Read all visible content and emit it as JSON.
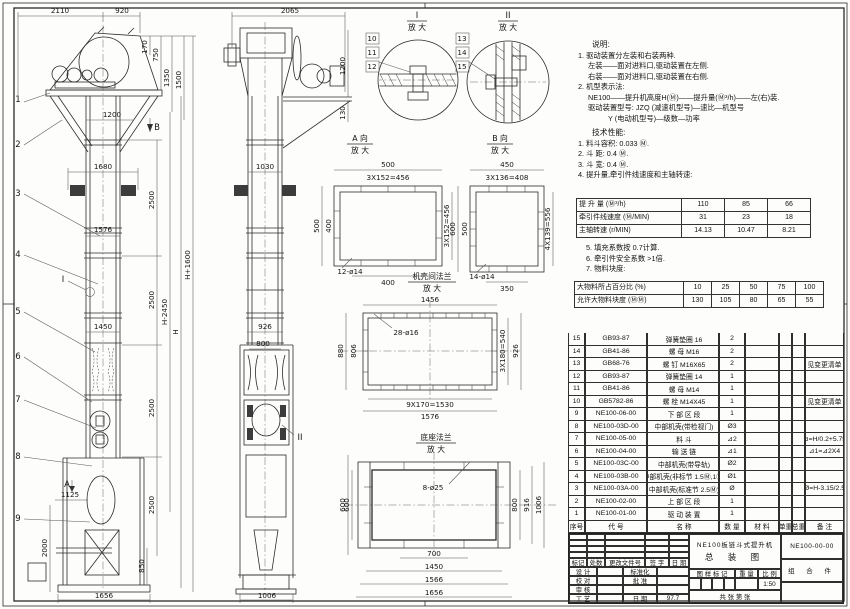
{
  "sheet": {
    "kind": "engineering-drawing"
  },
  "v1": {
    "callouts": [
      "1",
      "2",
      "3",
      "4",
      "5",
      "6",
      "7",
      "8",
      "9"
    ],
    "detail_mark": "I",
    "dim_2110": "2110",
    "dim_920": "920",
    "dim_170": "170",
    "dim_750": "750",
    "dim_1350": "1350",
    "dim_1500": "1500",
    "dim_1200": "1200",
    "view_b": "B",
    "dim_1680": "1680",
    "dim_2500": "2500",
    "dim_1576": "1576",
    "dim_1450": "1450",
    "dim_h2450": "H-2450",
    "dim_h": "H",
    "dim_h1600": "H+1600",
    "dim_1125": "1125",
    "dim_2000": "2000",
    "dim_850": "850",
    "dim_1656": "1656",
    "view_a": "A"
  },
  "v2": {
    "dim_2065": "2065",
    "dim_1200": "1200",
    "dim_130": "130",
    "dim_1030": "1030",
    "dim_926": "926",
    "dim_800": "800",
    "dim_600": "600",
    "dim_1006": "1006",
    "detail_mark": "II"
  },
  "detail1": {
    "label": "I",
    "sub": "放 大",
    "c10": "10",
    "c11": "11",
    "c12": "12"
  },
  "detail2": {
    "label": "II",
    "sub": "放 大",
    "c13": "13",
    "c14": "14",
    "c15": "15"
  },
  "viewA": {
    "title": "A 向",
    "sub": "放 大",
    "top": "500",
    "top2": "3X152=456",
    "left": "500",
    "left2": "400",
    "right": "3X152=456",
    "bottom": "400",
    "holes": "12-ø14"
  },
  "viewB": {
    "title": "B 向",
    "sub": "放 大",
    "top": "450",
    "top2": "3X136=408",
    "left": "600",
    "left2": "500",
    "right": "4X139=556",
    "bottom": "350",
    "holes": "14-ø14"
  },
  "flange1": {
    "title": "机壳间法兰",
    "sub": "放 大",
    "top": "1456",
    "holes": "28-ø16",
    "left": "880",
    "left2": "806",
    "right": "3X180=540",
    "right2": "926",
    "bottom": "9X170=1530",
    "bottom2": "1576"
  },
  "flange2": {
    "title": "底座法兰",
    "sub": "放 大",
    "holes": "8-ø25",
    "left": "600",
    "right": "800",
    "right2": "916",
    "right3": "1006",
    "bottom": "700",
    "bottom2": "1450",
    "bottom3": "1566",
    "bottom4": "1656"
  },
  "notes": {
    "title": "说明:",
    "n1": "1. 驱动装置分左装和右装两种.",
    "n2": "左装——面对进料口,驱动装置在左侧.",
    "n3": "右装——面对进料口,驱动装置在右侧.",
    "n4": "2. 机型表示法:",
    "n5": "NE100——提升机高度H(Ⓜ)——提升量(Ⓜ³/h)——左(右)装.",
    "n6": "驱动装置型号: JZQ (减速机型号)—速比—机型号",
    "n7": "Y (电动机型号)—级数—功率",
    "tech_title": "技术性能:",
    "t1": "1. 料斗容积: 0.033 Ⓜ.",
    "t2": "2. 斗    距: 0.4 Ⓜ.",
    "t3": "3. 斗    宽: 0.4 Ⓜ.",
    "t4": "4. 提升量,牵引件线速度和主轴转速:",
    "t5": "5. 填充系数按 0.7计算.",
    "t6": "6. 牵引件安全系数 >1倍.",
    "t7": "7. 物料块度:"
  },
  "chart_data": {
    "type": "table",
    "title": "提升量、牵引件线速度和主轴转速",
    "perf_rows": [
      {
        "label": "提 升 量 (Ⓜ³/h)",
        "v1": "110",
        "v2": "85",
        "v3": "66"
      },
      {
        "label": "牵引件线速度 (Ⓜ/MIN)",
        "v1": "31",
        "v2": "23",
        "v3": "18"
      },
      {
        "label": "主轴转速 (r/MIN)",
        "v1": "14.13",
        "v2": "10.47",
        "v3": "8.21"
      }
    ],
    "size_rows": [
      {
        "label": "大物料所占百分比 (%)",
        "v1": "10",
        "v2": "25",
        "v3": "50",
        "v4": "75",
        "v5": "100"
      },
      {
        "label": "允许大物料块度 (ⓂⓂ)",
        "v1": "130",
        "v2": "105",
        "v3": "80",
        "v4": "65",
        "v5": "55"
      }
    ]
  },
  "bom": {
    "headers": {
      "seq": "序号",
      "code": "代    号",
      "name": "名    称",
      "qty": "数 量",
      "mat": "材  料",
      "uw": "单重",
      "tw": "总重",
      "note": "备  注"
    },
    "rows": [
      {
        "seq": "15",
        "code": "GB93-87",
        "name": "弹簧垫圈  16",
        "qty": "2",
        "mat": "",
        "uw": "",
        "tw": "",
        "note": ""
      },
      {
        "seq": "14",
        "code": "GB41-86",
        "name": "螺  母  M16",
        "qty": "2",
        "mat": "",
        "uw": "",
        "tw": "",
        "note": ""
      },
      {
        "seq": "13",
        "code": "GB68-76",
        "name": "螺  钉  M16X65",
        "qty": "2",
        "mat": "",
        "uw": "",
        "tw": "",
        "note": "见变更清单"
      },
      {
        "seq": "12",
        "code": "GB93-87",
        "name": "弹簧垫圈  14",
        "qty": "1",
        "mat": "",
        "uw": "",
        "tw": "",
        "note": ""
      },
      {
        "seq": "11",
        "code": "GB41-86",
        "name": "螺  母  M14",
        "qty": "1",
        "mat": "",
        "uw": "",
        "tw": "",
        "note": ""
      },
      {
        "seq": "10",
        "code": "GB5782-86",
        "name": "螺  栓  M14X45",
        "qty": "1",
        "mat": "",
        "uw": "",
        "tw": "",
        "note": "见变更清单"
      },
      {
        "seq": "9",
        "code": "NE100-06-00",
        "name": "下 部 区 段",
        "qty": "1",
        "mat": "",
        "uw": "",
        "tw": "",
        "note": ""
      },
      {
        "seq": "8",
        "code": "NE100-03D-00",
        "name": "中部机壳(带检视门)",
        "qty": "Ø3",
        "mat": "",
        "uw": "",
        "tw": "",
        "note": ""
      },
      {
        "seq": "7",
        "code": "NE100-05-00",
        "name": "料  斗",
        "qty": "⊿2",
        "mat": "",
        "uw": "",
        "tw": "",
        "note": "⊿=H/0.2+5.75"
      },
      {
        "seq": "6",
        "code": "NE100-04-00",
        "name": "输 送 链",
        "qty": "⊿1",
        "mat": "",
        "uw": "",
        "tw": "",
        "note": "⊿1=⊿2X4"
      },
      {
        "seq": "5",
        "code": "NE100-03C-00",
        "name": "中部机壳(带导轨)",
        "qty": "Ø2",
        "mat": "",
        "uw": "",
        "tw": "",
        "note": ""
      },
      {
        "seq": "4",
        "code": "NE100-03B-00",
        "name": "中部机壳(非标节 1.5Ⓜ,1Ⓜ)",
        "qty": "Ø1",
        "mat": "",
        "uw": "",
        "tw": "",
        "note": ""
      },
      {
        "seq": "3",
        "code": "NE100-03A-00",
        "name": "中部机壳(标准节 2.5Ⓜ)",
        "qty": "Ø",
        "mat": "",
        "uw": "",
        "tw": "",
        "note": "Ø=H-3.15/2.5"
      },
      {
        "seq": "2",
        "code": "NE100-02-00",
        "name": "上 部 区 段",
        "qty": "1",
        "mat": "",
        "uw": "",
        "tw": "",
        "note": ""
      },
      {
        "seq": "1",
        "code": "NE100-01-00",
        "name": "驱 动 装 置",
        "qty": "1",
        "mat": "",
        "uw": "",
        "tw": "",
        "note": ""
      }
    ]
  },
  "title_block": {
    "product_line1": "NE100板链斗式提升机",
    "product_line2": "总 装 图",
    "drawing_no": "NE100-00-00",
    "part_type": "组 合 件",
    "rev_headers": {
      "h1": "标记",
      "h2": "处数",
      "h3": "更改文件号",
      "h4": "签 字",
      "h5": "日 期"
    },
    "roles": {
      "r1": "设 计",
      "r2": "校 对",
      "r3": "审 核",
      "r4": "工 艺",
      "s1": "标准化",
      "s2": "批 准",
      "s4": "日 期",
      "date": "97.7"
    },
    "stamp": {
      "h1": "图 样 标 记",
      "h2": "重 量",
      "h3": "比 例",
      "scale": "1:50",
      "sheets": "共  张  第  张"
    }
  }
}
